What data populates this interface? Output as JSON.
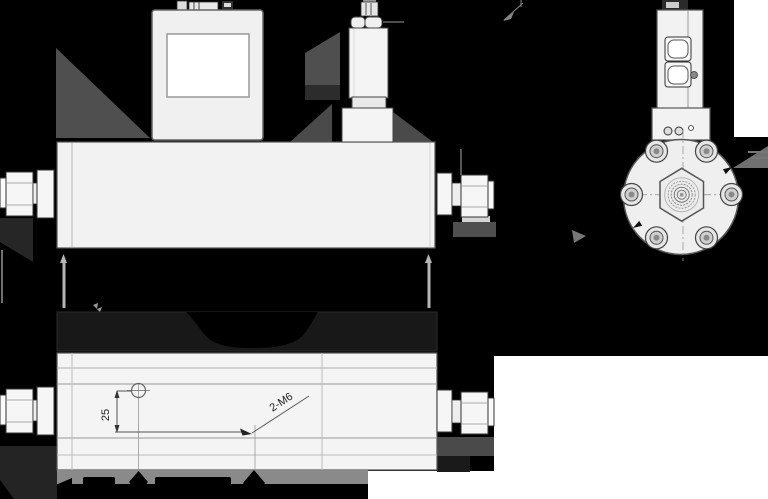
{
  "drawing": {
    "title": "flow-controller-dimension-drawing",
    "background_color": "#000000",
    "paper_color": "#ffffff",
    "body_fill": "#f2f2f2",
    "line_color": "#333333",
    "shadow_color": "#4f4f4f",
    "band_color": "#8a8a8a",
    "labels": {
      "offset_dim": "25",
      "thread_callout": "2-M6"
    }
  }
}
